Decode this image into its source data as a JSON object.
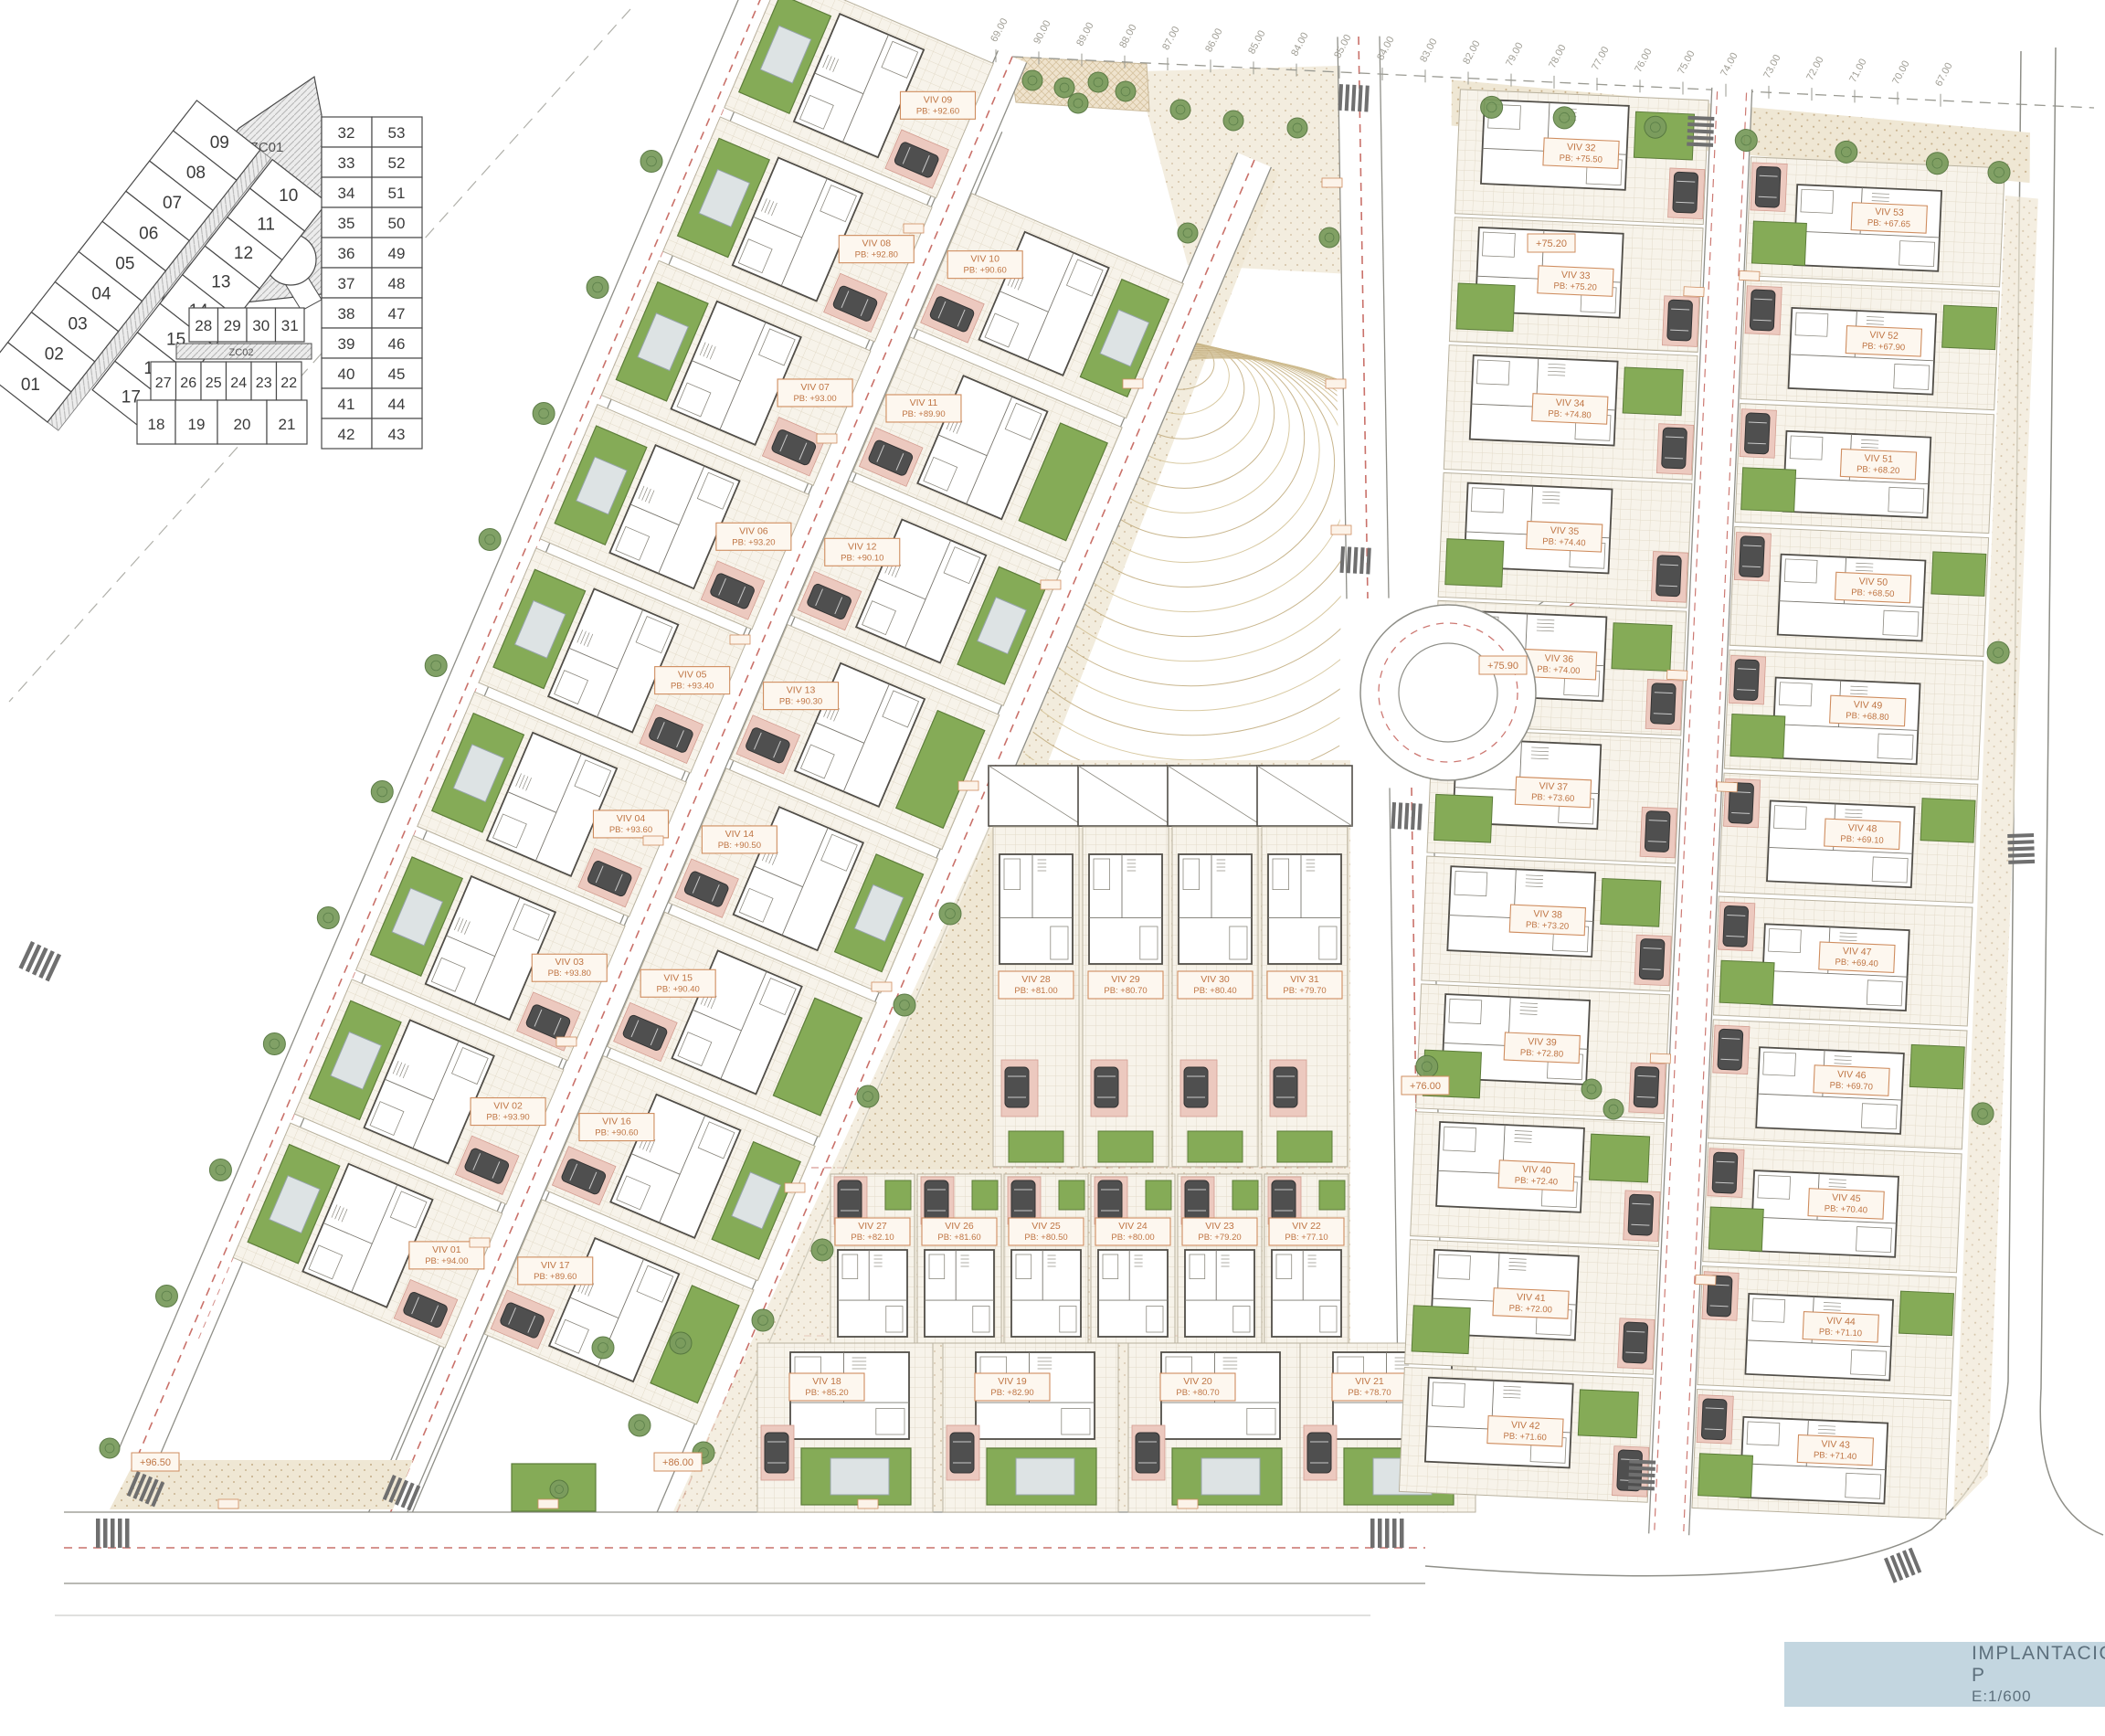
{
  "title_block": {
    "title": "IMPLANTACIÓN P",
    "scale": "E:1/600"
  },
  "key_plan": {
    "zones": {
      "zc01": "ZC01",
      "zc02": "ZC02"
    },
    "outer_row": [
      "09",
      "08",
      "07",
      "06",
      "05",
      "04",
      "03",
      "02",
      "01"
    ],
    "inner_row": [
      "10",
      "11",
      "12",
      "13",
      "14",
      "15",
      "16",
      "17"
    ],
    "row_a": [
      "28",
      "29",
      "30",
      "31"
    ],
    "row_b": [
      "27",
      "26",
      "25",
      "24",
      "23",
      "22"
    ],
    "row_c": [
      "18",
      "19",
      "20",
      "21"
    ],
    "right_pairs": [
      [
        "32",
        "53"
      ],
      [
        "33",
        "52"
      ],
      [
        "34",
        "51"
      ],
      [
        "35",
        "50"
      ],
      [
        "36",
        "49"
      ],
      [
        "37",
        "48"
      ],
      [
        "38",
        "47"
      ],
      [
        "39",
        "46"
      ],
      [
        "40",
        "45"
      ],
      [
        "41",
        "44"
      ],
      [
        "42",
        "43"
      ]
    ]
  },
  "villas": {
    "left_outer": [
      {
        "label": "VIV 09",
        "pb": "PB: +92.60"
      },
      {
        "label": "VIV 08",
        "pb": "PB: +92.80"
      },
      {
        "label": "VIV 07",
        "pb": "PB: +93.00"
      },
      {
        "label": "VIV 06",
        "pb": "PB: +93.20"
      },
      {
        "label": "VIV 05",
        "pb": "PB: +93.40"
      },
      {
        "label": "VIV 04",
        "pb": "PB: +93.60"
      },
      {
        "label": "VIV 03",
        "pb": "PB: +93.80"
      },
      {
        "label": "VIV 02",
        "pb": "PB: +93.90"
      },
      {
        "label": "VIV 01",
        "pb": "PB: +94.00"
      }
    ],
    "left_inner": [
      {
        "label": "VIV 10",
        "pb": "PB: +90.60"
      },
      {
        "label": "VIV 11",
        "pb": "PB: +89.90"
      },
      {
        "label": "VIV 12",
        "pb": "PB: +90.10"
      },
      {
        "label": "VIV 13",
        "pb": "PB: +90.30"
      },
      {
        "label": "VIV 14",
        "pb": "PB: +90.50"
      },
      {
        "label": "VIV 15",
        "pb": "PB: +90.40"
      },
      {
        "label": "VIV 16",
        "pb": "PB: +90.60"
      },
      {
        "label": "VIV 17",
        "pb": "PB: +89.60"
      }
    ],
    "mid_row_a": [
      {
        "label": "VIV 28",
        "pb": "PB: +81.00"
      },
      {
        "label": "VIV 29",
        "pb": "PB: +80.70"
      },
      {
        "label": "VIV 30",
        "pb": "PB: +80.40"
      },
      {
        "label": "VIV 31",
        "pb": "PB: +79.70"
      }
    ],
    "mid_row_b": [
      {
        "label": "VIV 27",
        "pb": "PB: +82.10"
      },
      {
        "label": "VIV 26",
        "pb": "PB: +81.60"
      },
      {
        "label": "VIV 25",
        "pb": "PB: +80.50"
      },
      {
        "label": "VIV 24",
        "pb": "PB: +80.00"
      },
      {
        "label": "VIV 23",
        "pb": "PB: +79.20"
      },
      {
        "label": "VIV 22",
        "pb": "PB: +77.10"
      }
    ],
    "mid_row_c": [
      {
        "label": "VIV 18",
        "pb": "PB: +85.20"
      },
      {
        "label": "VIV 19",
        "pb": "PB: +82.90"
      },
      {
        "label": "VIV 20",
        "pb": "PB: +80.70"
      },
      {
        "label": "VIV 21",
        "pb": "PB: +78.70"
      }
    ],
    "right_col_left": [
      {
        "label": "VIV 32",
        "pb": "PB: +75.50"
      },
      {
        "label": "VIV 33",
        "pb": "PB: +75.20"
      },
      {
        "label": "VIV 34",
        "pb": "PB: +74.80"
      },
      {
        "label": "VIV 35",
        "pb": "PB: +74.40"
      },
      {
        "label": "VIV 36",
        "pb": "PB: +74.00"
      },
      {
        "label": "VIV 37",
        "pb": "PB: +73.60"
      },
      {
        "label": "VIV 38",
        "pb": "PB: +73.20"
      },
      {
        "label": "VIV 39",
        "pb": "PB: +72.80"
      },
      {
        "label": "VIV 40",
        "pb": "PB: +72.40"
      },
      {
        "label": "VIV 41",
        "pb": "PB: +72.00"
      },
      {
        "label": "VIV 42",
        "pb": "PB: +71.60"
      }
    ],
    "right_col_right": [
      {
        "label": "VIV 53",
        "pb": "PB: +67.65"
      },
      {
        "label": "VIV 52",
        "pb": "PB: +67.90"
      },
      {
        "label": "VIV 51",
        "pb": "PB: +68.20"
      },
      {
        "label": "VIV 50",
        "pb": "PB: +68.50"
      },
      {
        "label": "VIV 49",
        "pb": "PB: +68.80"
      },
      {
        "label": "VIV 48",
        "pb": "PB: +69.10"
      },
      {
        "label": "VIV 47",
        "pb": "PB: +69.40"
      },
      {
        "label": "VIV 46",
        "pb": "PB: +69.70"
      },
      {
        "label": "VIV 45",
        "pb": "PB: +70.40"
      },
      {
        "label": "VIV 44",
        "pb": "PB: +71.10"
      },
      {
        "label": "VIV 43",
        "pb": "PB: +71.40"
      }
    ]
  },
  "road_labels": [
    "+75.90",
    "+75.20",
    "+76.00",
    "+96.50",
    "+86.00"
  ],
  "top_elevations": [
    "69.00",
    "90.00",
    "89.00",
    "88.00",
    "87.00",
    "86.00",
    "85.00",
    "84.00",
    "85.00",
    "84.00",
    "83.00",
    "82.00",
    "79.00",
    "78.00",
    "77.00",
    "76.00",
    "75.00",
    "74.00",
    "73.00",
    "72.00",
    "71.00",
    "70.00",
    "67.00"
  ],
  "colors": {
    "accent_orange": "#bf7544",
    "label_border": "#cf8d5f",
    "pool_green": "#85ab57",
    "pool_green_dark": "#5d7d3a",
    "water": "#dde3e4",
    "road_red_dash": "#c4625a",
    "line": "#8f8f88",
    "dark_line": "#514e48",
    "contour": "#c9b483",
    "titlebar_blue": "#c3d6e0",
    "tree_green": "#7b9c5e"
  }
}
